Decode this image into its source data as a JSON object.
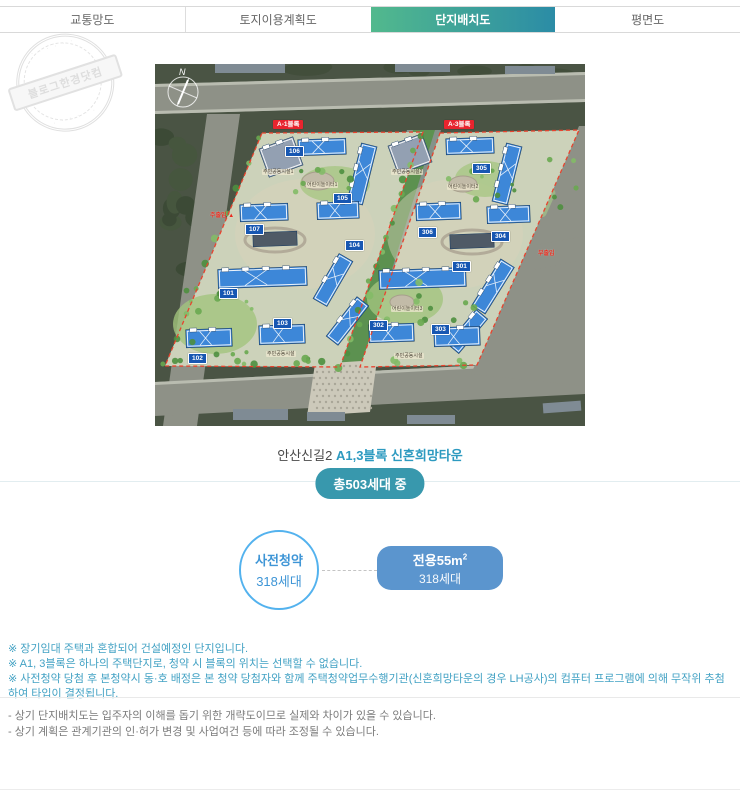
{
  "tabs": [
    {
      "label": "교통망도",
      "active": false
    },
    {
      "label": "토지이용계획도",
      "active": false
    },
    {
      "label": "단지배치도",
      "active": true
    },
    {
      "label": "평면도",
      "active": false
    }
  ],
  "watermark": {
    "text": "블로그한경닷컴"
  },
  "siteplan": {
    "compass": "N",
    "block_badges": [
      {
        "label": "A-1블록",
        "x": 118,
        "y": 56
      },
      {
        "label": "A-3블록",
        "x": 289,
        "y": 56
      }
    ],
    "unit_badges": [
      {
        "num": "106",
        "x": 130,
        "y": 82
      },
      {
        "num": "105",
        "x": 178,
        "y": 129
      },
      {
        "num": "107",
        "x": 90,
        "y": 160
      },
      {
        "num": "104",
        "x": 190,
        "y": 176
      },
      {
        "num": "101",
        "x": 64,
        "y": 224
      },
      {
        "num": "103",
        "x": 118,
        "y": 254
      },
      {
        "num": "102",
        "x": 33,
        "y": 289
      },
      {
        "num": "305",
        "x": 317,
        "y": 99
      },
      {
        "num": "306",
        "x": 263,
        "y": 163
      },
      {
        "num": "304",
        "x": 336,
        "y": 167
      },
      {
        "num": "301",
        "x": 297,
        "y": 197
      },
      {
        "num": "302",
        "x": 214,
        "y": 256
      },
      {
        "num": "303",
        "x": 276,
        "y": 260
      }
    ],
    "entrance_badges": [
      {
        "label": "주출입 ▲",
        "x": 55,
        "y": 146
      },
      {
        "label": "부출입",
        "x": 383,
        "y": 184
      }
    ],
    "facility_labels": [
      {
        "label": "주민공동시설1",
        "x": 107,
        "y": 105
      },
      {
        "label": "어린이놀이터1",
        "x": 151,
        "y": 118
      },
      {
        "label": "주민공동시설2",
        "x": 236,
        "y": 105
      },
      {
        "label": "어린이놀이터2",
        "x": 292,
        "y": 120
      },
      {
        "label": "어린이놀이터3",
        "x": 236,
        "y": 242
      },
      {
        "label": "주민공동시설",
        "x": 111,
        "y": 287
      },
      {
        "label": "주민공동시설",
        "x": 239,
        "y": 289
      }
    ]
  },
  "caption": {
    "prefix": "안산신길2",
    "highlight": "A1,3블록 신혼희망타운"
  },
  "total_badge": "총503세대 중",
  "supply": {
    "circle_line1": "사전청약",
    "circle_line2": "318세대",
    "box_title": "전용55m",
    "box_sup": "2",
    "box_units": "318세대"
  },
  "notes_primary": [
    "※ 장기임대 주택과 혼합되어 건설예정인 단지입니다.",
    "※ A1, 3블록은 하나의 주택단지로, 청약 시 블록의 위치는 선택할 수 없습니다.",
    "※ 사전청약 당첨 후 본청약시 동·호 배정은 본 청약 당첨자와 함께 주택청약업무수행기관(신혼희망타운의 경우 LH공사)의 컴퓨터 프로그램에 의해 무작위 추첨하여 타입이 결정됩니다."
  ],
  "notes_secondary": [
    "- 상기 단지배치도는 입주자의 이해를 돕기 위한 개략도이므로 실제와 차이가 있을 수 있습니다.",
    "- 상기 계획은 관계기관의 인·허가 변경 및 사업여건 등에 따라 조정될 수 있습니다."
  ],
  "colors": {
    "accent_teal": "#3898ad",
    "accent_blue": "#5b95ce",
    "tab_gradient_start": "#52b98d",
    "tab_gradient_end": "#2b8ca6",
    "building_blue": "#3d87d8",
    "boundary_red": "#e8432e"
  }
}
